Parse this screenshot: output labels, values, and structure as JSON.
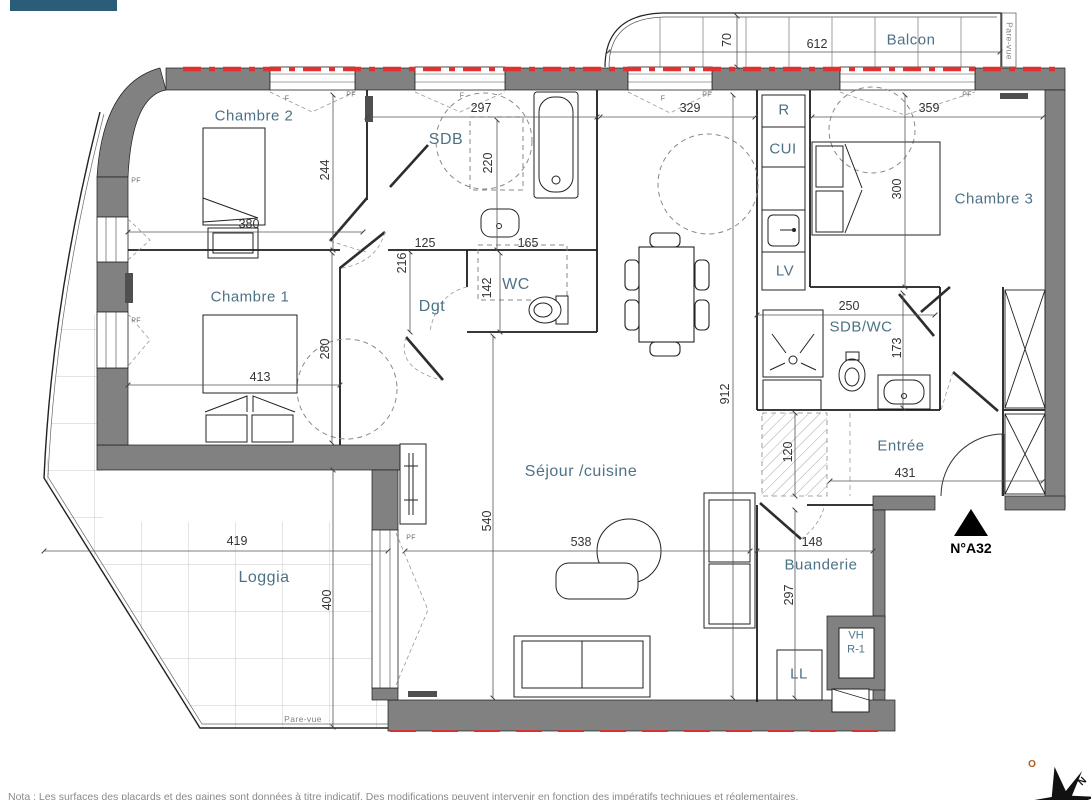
{
  "rooms": {
    "chambre2": "Chambre 2",
    "chambre1": "Chambre 1",
    "chambre3": "Chambre 3",
    "sdb": "SDB",
    "wc": "WC",
    "dgt": "Dgt",
    "sejour": "Séjour /cuisine",
    "entree": "Entrée",
    "loggia": "Loggia",
    "buanderie": "Buanderie",
    "balcon": "Balcon",
    "sdb_wc": "SDB/WC"
  },
  "appliances": {
    "refrigerator": "R",
    "kitchen": "CUI",
    "dishwasher": "LV",
    "washing_machine": "LL",
    "vent_line1": "VH",
    "vent_line2": "R-1"
  },
  "dims": {
    "d70": "70",
    "d612": "612",
    "d297_top": "297",
    "d329": "329",
    "d359": "359",
    "d244": "244",
    "d220": "220",
    "d380": "380",
    "d125": "125",
    "d216": "216",
    "d165": "165",
    "d142": "142",
    "d300": "300",
    "d413": "413",
    "d280": "280",
    "d250": "250",
    "d173": "173",
    "d912": "912",
    "d120": "120",
    "d431": "431",
    "d540": "540",
    "d538": "538",
    "d148": "148",
    "d297_buanderie": "297",
    "d419": "419",
    "d400": "400"
  },
  "annotations": {
    "unit_number": "N°A32",
    "pare_vue_right": "Pare-vue",
    "pare_vue_bottom": "Pare-vue",
    "pf": "PF",
    "f": "F",
    "note": "Nota : Les surfaces des placards et des gaines sont données à titre indicatif. Des modifications peuvent intervenir en fonction des impératifs techniques et réglementaires."
  },
  "compass": {
    "west": "O",
    "north": "N"
  },
  "colors": {
    "accent_tab": "#2c5d78",
    "wall": "#818181",
    "red_line": "#e03030",
    "room_label": "#4d7286"
  }
}
